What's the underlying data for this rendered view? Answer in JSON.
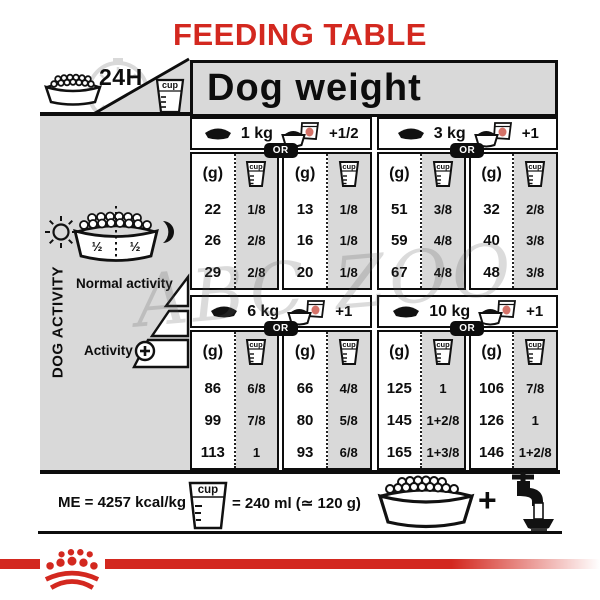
{
  "title": "FEEDING TABLE",
  "header": {
    "daily": "24H",
    "dog_weight": "Dog weight"
  },
  "labels": {
    "g": "(g)",
    "cup": "cup",
    "or": "OR"
  },
  "activity": {
    "panel_title": "DOG ACTIVITY",
    "normal": "Normal activity",
    "active": "Activity",
    "bowl_half_left": "½",
    "bowl_half_right": "½"
  },
  "sections": [
    {
      "weight": "1 kg",
      "extra": "+1/2",
      "dry_g": [
        "22",
        "26",
        "29"
      ],
      "dry_cup": [
        "1/8",
        "2/8",
        "2/8"
      ],
      "mix_g": [
        "13",
        "16",
        "20"
      ],
      "mix_cup": [
        "1/8",
        "1/8",
        "1/8"
      ]
    },
    {
      "weight": "3 kg",
      "extra": "+1",
      "dry_g": [
        "51",
        "59",
        "67"
      ],
      "dry_cup": [
        "3/8",
        "4/8",
        "4/8"
      ],
      "mix_g": [
        "32",
        "40",
        "48"
      ],
      "mix_cup": [
        "2/8",
        "3/8",
        "3/8"
      ]
    },
    {
      "weight": "6 kg",
      "extra": "+1",
      "dry_g": [
        "86",
        "99",
        "113"
      ],
      "dry_cup": [
        "6/8",
        "7/8",
        "1"
      ],
      "mix_g": [
        "66",
        "80",
        "93"
      ],
      "mix_cup": [
        "4/8",
        "5/8",
        "6/8"
      ]
    },
    {
      "weight": "10 kg",
      "extra": "+1",
      "dry_g": [
        "125",
        "145",
        "165"
      ],
      "dry_cup": [
        "1",
        "1+2/8",
        "1+3/8"
      ],
      "mix_g": [
        "106",
        "126",
        "146"
      ],
      "mix_cup": [
        "7/8",
        "1",
        "1+2/8"
      ]
    }
  ],
  "footer": {
    "me": "ME = 4257 kcal/kg",
    "cup_equiv": "= 240 ml (≃ 120 g)",
    "plus": "+"
  },
  "watermark": "ABC ZOO",
  "colors": {
    "brand_red": "#d3281f",
    "panel_gray": "#d9d9d9"
  }
}
